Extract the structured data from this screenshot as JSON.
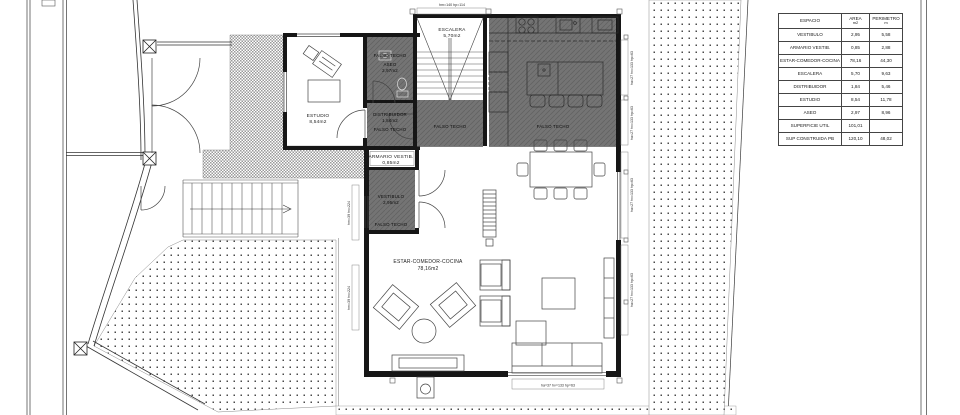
{
  "drawing": {
    "rooms": {
      "escalera": {
        "name": "ESCALERA",
        "area": "5,70m2"
      },
      "estudio": {
        "name": "ESTUDIO",
        "area": "8,54m2"
      },
      "aseo": {
        "name": "ASEO",
        "area": "2,97m2"
      },
      "distribuidor": {
        "name": "DISTRIBUIDOR",
        "area": "1,84m2"
      },
      "armario": {
        "name": "ARMARIO VESTIB.",
        "area": "0,85m2"
      },
      "vestibulo": {
        "name": "VESTIBULO",
        "area": "2,95m2"
      },
      "estar": {
        "name": "ESTAR-COMEDOR-COCINA",
        "area": "78,16m2"
      }
    },
    "ceiling_label": "FALSO TECHO",
    "dims": {
      "top": "hm=140  hp=114",
      "bottom": "ha=37  hv=133  hp=63",
      "right_a": "ha=27  hv=133  hp=63",
      "right_b": "ha=27  hv=133  hp=63",
      "right_c": "ha=27  hv=133  hp=63",
      "right_d": "ha=27  hv=133  hp=63",
      "side_a": "hm=39  hv=224",
      "side_b": "hm=39  hv=224"
    },
    "colors": {
      "wall": "#161616",
      "dark_room": "#747474",
      "paper": "#ffffff"
    }
  },
  "table": {
    "headers": {
      "espacio": "ESPACIO",
      "area": "AREA",
      "area_unit": "m2",
      "perimetro": "PERIMETRO",
      "perimetro_unit": "m"
    },
    "rows": [
      {
        "name": "VESTIBULO",
        "area": "2,95",
        "per": "5,58"
      },
      {
        "name": "ARMARIO VESTIB.",
        "area": "0,85",
        "per": "2,88"
      },
      {
        "name": "ESTAR-COMEDOR-COCINA",
        "area": "78,16",
        "per": "44,30"
      },
      {
        "name": "ESCALERA",
        "area": "5,70",
        "per": "9,63"
      },
      {
        "name": "DISTRIBUIDOR",
        "area": "1,84",
        "per": "5,46"
      },
      {
        "name": "ESTUDIO",
        "area": "8,54",
        "per": "11,78"
      },
      {
        "name": "ASEO",
        "area": "2,97",
        "per": "8,96"
      },
      {
        "name": "SUPERFICIE UTIL",
        "area": "101,01",
        "per": ""
      },
      {
        "name": "SUP CONSTRUIDA PB",
        "area": "120,10",
        "per": "48,02"
      }
    ]
  }
}
